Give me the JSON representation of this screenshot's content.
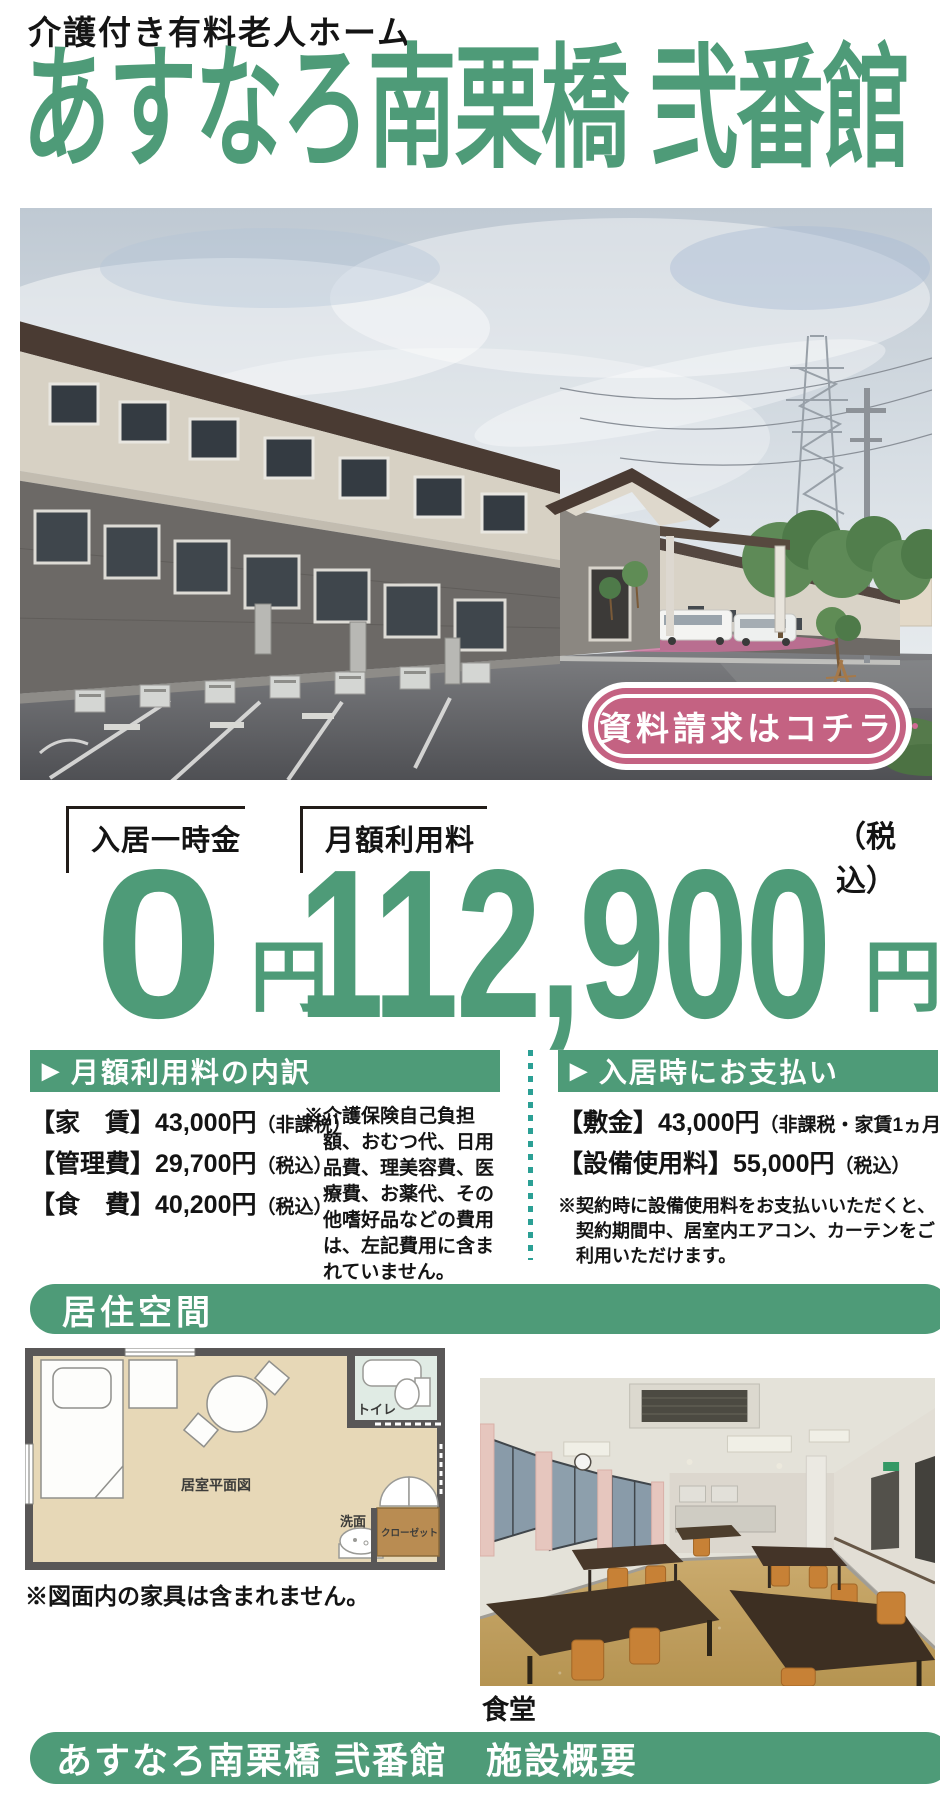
{
  "colors": {
    "accent_green": "#4e9b78",
    "badge_pink": "#c46282",
    "divider_teal": "#2ba095",
    "text_black": "#141414"
  },
  "icons": {
    "arrow": "▶"
  },
  "header": {
    "category": "介護付き有料老人ホーム",
    "title": "あすなろ南栗橋 弐番館"
  },
  "photo": {
    "badge_label": "資料請求はコチラ"
  },
  "pricing": {
    "move_in": {
      "label": "入居一時金",
      "amount": "0",
      "unit": "円"
    },
    "monthly": {
      "label": "月額利用料",
      "amount": "112,900",
      "unit": "円",
      "tax_note": "（税込）"
    }
  },
  "monthly_breakdown": {
    "header": "月額利用料の内訳",
    "items": [
      {
        "label": "【家　賃】",
        "value": "43,000円",
        "note": "（非課税）"
      },
      {
        "label": "【管理費】",
        "value": "29,700円",
        "note": "（税込）"
      },
      {
        "label": "【食　費】",
        "value": "40,200円",
        "note": "（税込）"
      }
    ],
    "note": "※介護保険自己負担額、おむつ代、日用品費、理美容費、医療費、お薬代、その他嗜好品などの費用は、左記費用に含まれていません。"
  },
  "move_in_payment": {
    "header": "入居時にお支払い",
    "items": [
      {
        "label": "【敷金】",
        "value": "43,000円",
        "note": "（非課税・家賃1ヵ月分）"
      },
      {
        "label": "【設備使用料】",
        "value": "55,000円",
        "note": "（税込）"
      }
    ],
    "note": "※契約時に設備使用料をお支払いいただくと、契約期間中、居室内エアコン、カーテンをご利用いただけます。"
  },
  "living_space": {
    "header": "居住空間",
    "floorplan": {
      "toilet": "トイレ",
      "plan_title": "居室平面図",
      "wash": "洗面",
      "closet": "クローゼット",
      "note": "※図面内の家具は含まれません。"
    },
    "dining_caption": "食堂"
  },
  "footer": {
    "title": "あすなろ南栗橋 弐番館　施設概要"
  }
}
